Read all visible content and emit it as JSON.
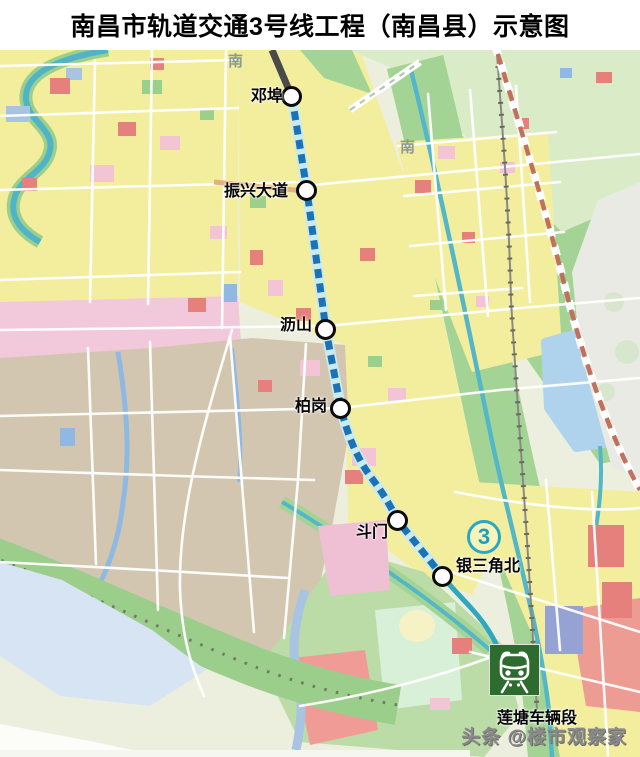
{
  "title": "南昌市轨道交通3号线工程（南昌县）示意图",
  "line": {
    "badge_number": "3",
    "dash_color": "#1B73B6",
    "casing_color": "#CBEAED",
    "tail_color": "#2FA8BE",
    "north_stub_color": "#4A4A4A"
  },
  "stations": [
    {
      "name": "邓埠"
    },
    {
      "name": "振兴大道"
    },
    {
      "name": "沥山"
    },
    {
      "name": "柏岗"
    },
    {
      "name": "斗门"
    },
    {
      "name": "银三角北"
    }
  ],
  "depot": {
    "label": "莲塘车辆段",
    "icon": "train-front-icon",
    "bg_color": "#2E6B2E"
  },
  "map_labels": [
    {
      "text": "南"
    },
    {
      "text": "南"
    }
  ],
  "watermark": {
    "text": "头条 @楼市观察家"
  },
  "colors": {
    "badge_teal": "#29A7C3",
    "station_ring": "#0B0B0B",
    "yellow_block": "#F3EE9E",
    "tan_block": "#D3C6B0",
    "park_green": "#A4D495",
    "water_blue": "#AFD3EC",
    "river_teal": "#53B7C8"
  }
}
